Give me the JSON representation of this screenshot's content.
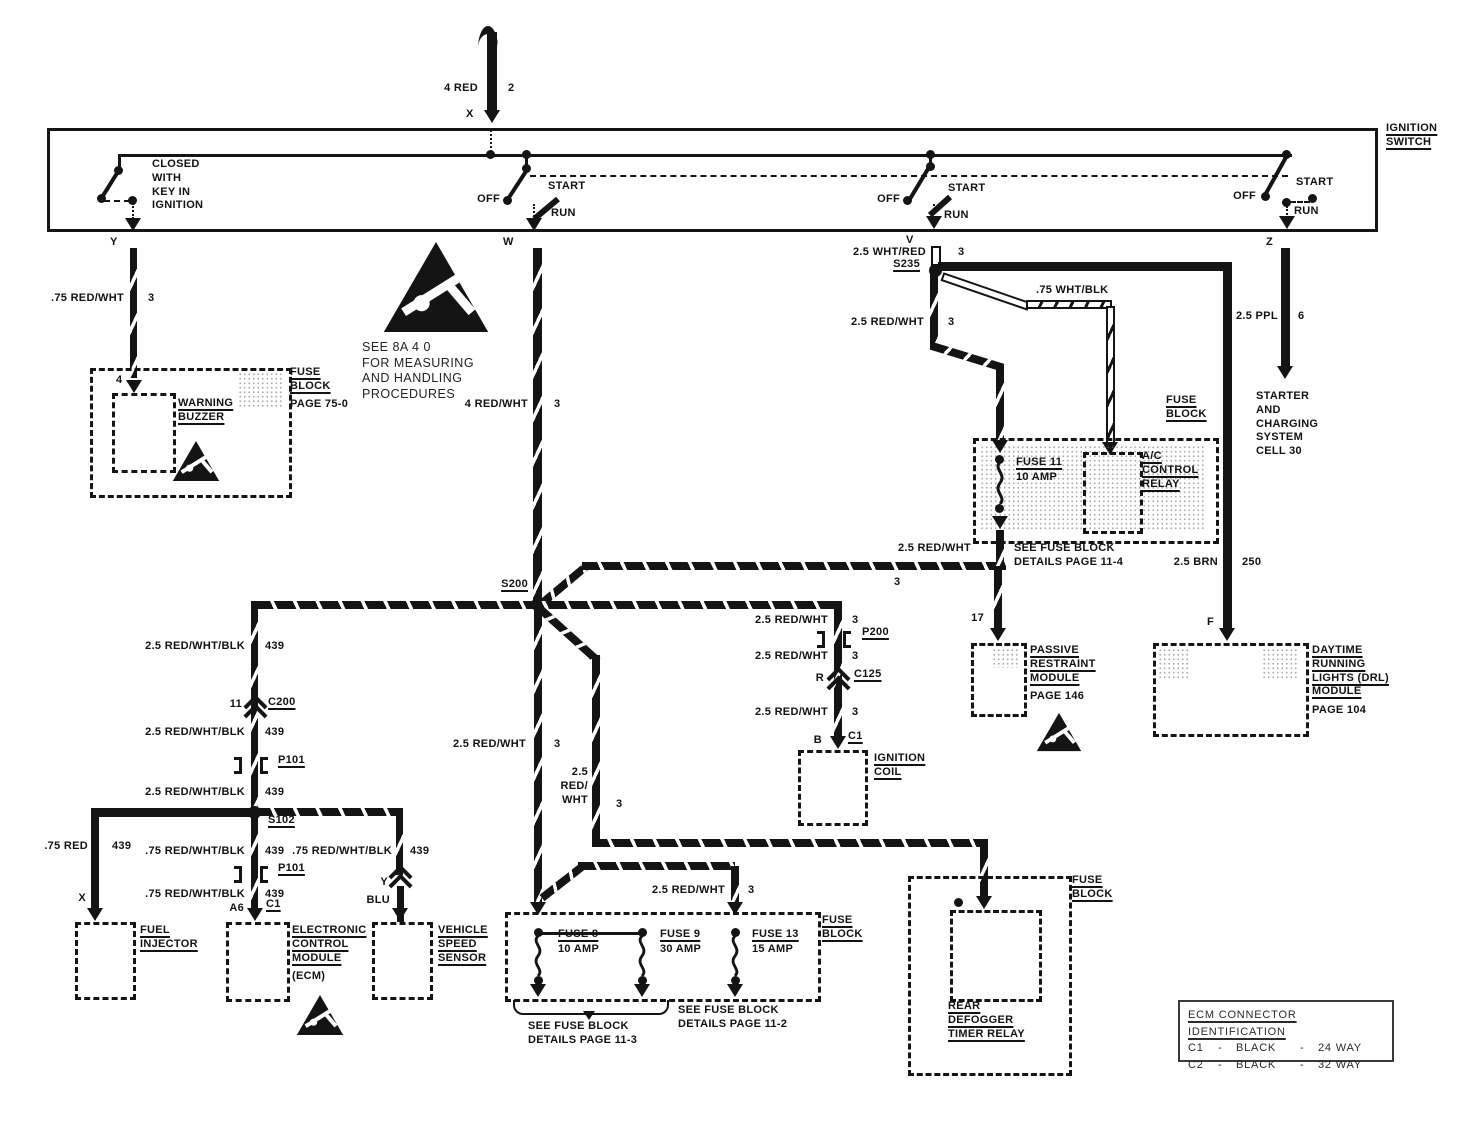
{
  "diagram": {
    "feed": {
      "wire": "4 RED",
      "circuit": "2",
      "terminal": "X"
    },
    "ign": {
      "title": "IGNITION\nSWITCH",
      "key_note": "CLOSED\nWITH\nKEY IN\nIGNITION",
      "sw1": {
        "off": "OFF",
        "start": "START",
        "run": "RUN"
      },
      "sw2": {
        "off": "OFF",
        "start": "START",
        "run": "RUN"
      },
      "sw3": {
        "off": "OFF",
        "start": "START",
        "run": "RUN"
      },
      "term_y": "Y",
      "term_w": "W",
      "term_v": "V",
      "term_z": "Z"
    },
    "buzzer": {
      "wire": ".75 RED/WHT",
      "circuit": "3",
      "terminal": "4",
      "name": "WARNING\nBUZZER",
      "ref": "FUSE\nBLOCK",
      "ref_page": "PAGE 75-0"
    },
    "esd_note": "SEE 8A 4 0\nFOR MEASURING\nAND HANDLING\nPROCEDURES",
    "run_wire": {
      "wire": "4 RED/WHT",
      "circuit": "3"
    },
    "s200": "S200",
    "s235": "S235",
    "v_wire": {
      "wire": "2.5 WHT/RED",
      "circuit": "3"
    },
    "whtblk": ".75 WHT/BLK",
    "s235_down": {
      "wire": "2.5 RED/WHT",
      "circuit": "3"
    },
    "ac": {
      "block": "FUSE\nBLOCK",
      "fuse": "FUSE 11",
      "rating": "10 AMP",
      "relay": "A/C\nCONTROL\nRELAY",
      "ref": "SEE FUSE BLOCK\nDETAILS PAGE 11-4"
    },
    "brn": {
      "wire": "2.5 BRN",
      "circuit": "250"
    },
    "drl": {
      "terminal": "F",
      "name": "DAYTIME\nRUNNING\nLIGHTS (DRL)\nMODULE",
      "page": "PAGE 104"
    },
    "ppl": {
      "wire": "2.5 PPL",
      "circuit": "6",
      "dest": "STARTER\nAND\nCHARGING\nSYSTEM\nCELL 30"
    },
    "prm": {
      "wire": "2.5 RED/WHT",
      "circuit": "3",
      "terminal": "17",
      "name": "PASSIVE\nRESTRAINT\nMODULE",
      "page": "PAGE 146"
    },
    "coil": {
      "w1": "2.5 RED/WHT",
      "c1": "3",
      "p200": "P200",
      "w2": "2.5 RED/WHT",
      "c2": "3",
      "r": "R",
      "c125": "C125",
      "w3": "2.5 RED/WHT",
      "c3": "3",
      "term": "B",
      "conn": "C1",
      "name": "IGNITION\nCOIL"
    },
    "left": {
      "w1": "2.5 RED/WHT/BLK",
      "c1": "439",
      "pin": "11",
      "c200": "C200",
      "w2": "2.5 RED/WHT/BLK",
      "c2": "439",
      "p101": "P101",
      "w3": "2.5 RED/WHT/BLK",
      "c3": "439",
      "s102": "S102"
    },
    "fuel": {
      "wire": ".75 RED",
      "circuit": "439",
      "terminal": "X",
      "name": "FUEL\nINJECTOR"
    },
    "ecm": {
      "w1": ".75 RED/WHT/BLK",
      "c1": "439",
      "p101": "P101",
      "w2": ".75 RED/WHT/BLK",
      "c2": "439",
      "term": "A6",
      "conn": "C1",
      "name": "ELECTRONIC\nCONTROL\nMODULE",
      "sub": "(ECM)"
    },
    "vss": {
      "wire": ".75 RED/WHT/BLK",
      "circuit": "439",
      "conn": "Y",
      "color": "BLU",
      "name": "VEHICLE\nSPEED\nSENSOR"
    },
    "mid": {
      "wire": "2.5 RED/WHT",
      "circuit": "3"
    },
    "defog_wire": {
      "wire": "2.5\nRED/\nWHT",
      "circuit": "3"
    },
    "f13_wire": {
      "wire": "2.5 RED/WHT",
      "circuit": "3"
    },
    "fb": {
      "label": "FUSE\nBLOCK",
      "f8": "FUSE 8",
      "f8r": "10 AMP",
      "f9": "FUSE 9",
      "f9r": "30 AMP",
      "f13": "FUSE 13",
      "f13r": "15 AMP",
      "see3": "SEE FUSE BLOCK\nDETAILS PAGE 11-3",
      "see2": "SEE FUSE BLOCK\nDETAILS PAGE 11-2"
    },
    "defog": {
      "label": "FUSE\nBLOCK",
      "name": "REAR\nDEFOGGER\nTIMER RELAY"
    },
    "table": {
      "title": "ECM CONNECTOR IDENTIFICATION",
      "rows": [
        {
          "c": "C1",
          "d1": "-",
          "col": "BLACK",
          "d2": "-",
          "w": "24 WAY"
        },
        {
          "c": "C2",
          "d1": "-",
          "col": "BLACK",
          "d2": "-",
          "w": "32 WAY"
        }
      ]
    }
  }
}
